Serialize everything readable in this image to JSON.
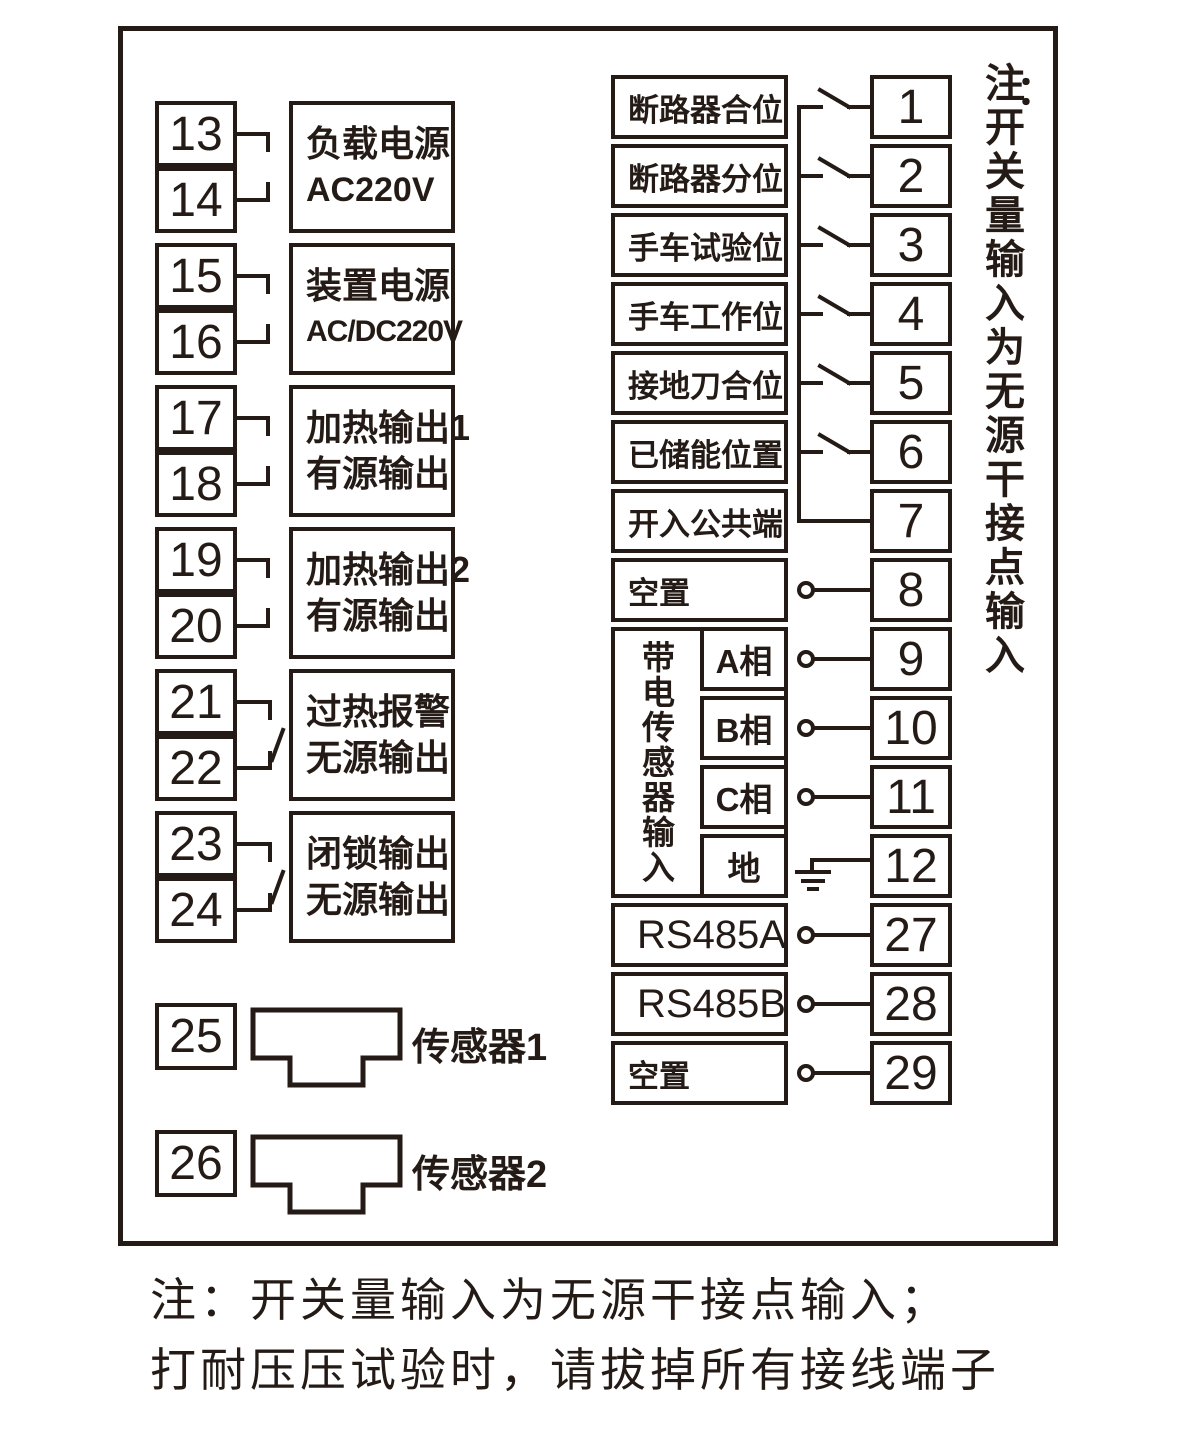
{
  "ink_color": "#241b16",
  "left": {
    "terminals": [
      "13",
      "14",
      "15",
      "16",
      "17",
      "18",
      "19",
      "20",
      "21",
      "22",
      "23",
      "24"
    ],
    "labels": [
      {
        "l1": "负载电源",
        "l2": "AC220V"
      },
      {
        "l1": "装置电源",
        "l2": "AC/DC220V"
      },
      {
        "l1": "加热输出1",
        "l2": "有源输出"
      },
      {
        "l1": "加热输出2",
        "l2": "有源输出"
      },
      {
        "l1": "过热报警",
        "l2": "无源输出"
      },
      {
        "l1": "闭锁输出",
        "l2": "无源输出"
      }
    ],
    "sensors": [
      {
        "terminal": "25",
        "label": "传感器1"
      },
      {
        "terminal": "26",
        "label": "传感器2"
      }
    ]
  },
  "right": {
    "rows": [
      {
        "label": "断路器合位",
        "terminal": "1"
      },
      {
        "label": "断路器分位",
        "terminal": "2"
      },
      {
        "label": "手车试验位",
        "terminal": "3"
      },
      {
        "label": "手车工作位",
        "terminal": "4"
      },
      {
        "label": "接地刀合位",
        "terminal": "5"
      },
      {
        "label": "已储能位置",
        "terminal": "6"
      },
      {
        "label": "开入公共端",
        "terminal": "7"
      },
      {
        "label": "空置",
        "terminal": "8"
      }
    ],
    "sensor_group": {
      "title": "带电传感器输入",
      "rows": [
        {
          "label": "A相",
          "terminal": "9"
        },
        {
          "label": "B相",
          "terminal": "10"
        },
        {
          "label": "C相",
          "terminal": "11"
        },
        {
          "label": "地",
          "terminal": "12"
        }
      ]
    },
    "comm_rows": [
      {
        "label": "RS485A",
        "terminal": "27"
      },
      {
        "label": "RS485B",
        "terminal": "28"
      },
      {
        "label": "空置",
        "terminal": "29"
      }
    ]
  },
  "side_note": {
    "prefix": "注",
    "colon": "：",
    "body": "开关量输入为无源干接点输入"
  },
  "bottom_note": {
    "line1": "注：开关量输入为无源干接点输入；",
    "line2": "打耐压压试验时，请拔掉所有接线端子"
  }
}
